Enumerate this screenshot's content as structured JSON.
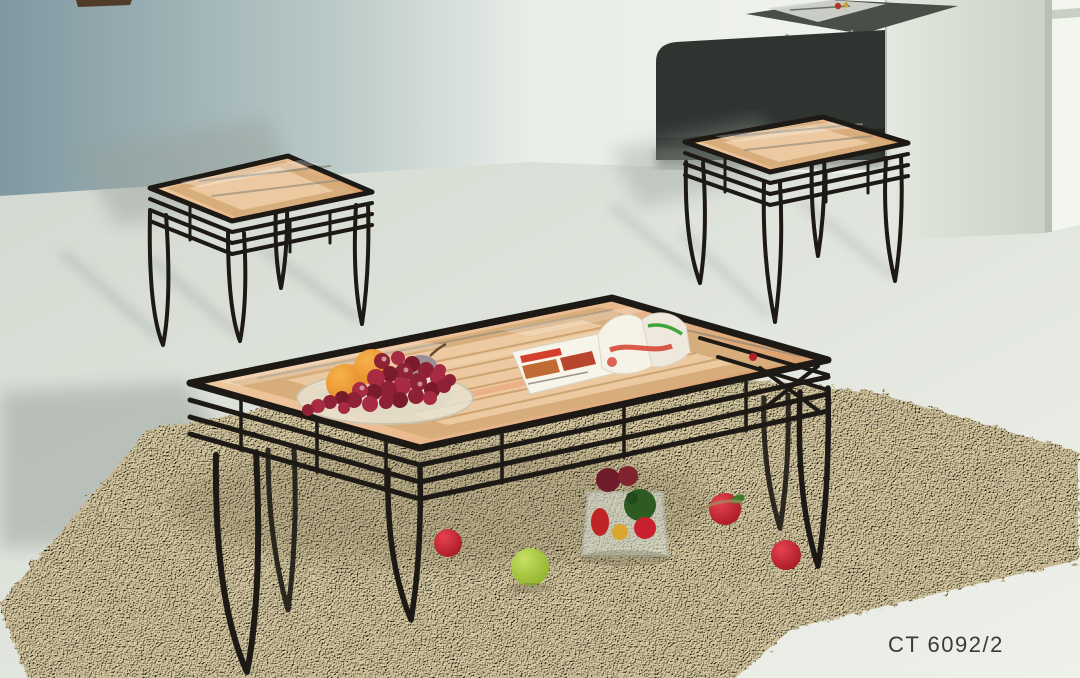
{
  "product": {
    "code": "CT 6092/2"
  },
  "scene": {
    "type": "furniture product photograph",
    "items": [
      "metal and glass coffee table",
      "left end table",
      "right end table",
      "beige shag rug",
      "glass plate with grapes and oranges",
      "open magazine",
      "glass vase with fruit and vegetables",
      "scattered red apples",
      "green apple",
      "glass desk with magazine",
      "dark chair back",
      "window strip"
    ]
  },
  "colors": {
    "wall_left": "#7f98a1",
    "wall_light": "#e9ede8",
    "window": "#f3f6ee",
    "window_frame": "#b7c0b5",
    "floor": "#dfe4db",
    "rug": "#c6b894",
    "rug_light": "#ddcfa6",
    "metal": "#1d1915",
    "lattice": "#8b8578",
    "wood": "#d8ad7c",
    "wood_light": "#ecc9a0",
    "glass_tint": "#ecd5b8",
    "chair": "#303431",
    "desk": "#494f47",
    "grapes": "#8e2133",
    "grapes_light": "#a72b42",
    "orange": "#ec9434",
    "plate": "#e9e6d6",
    "apple_red": "#c9202e",
    "apple_green": "#a4c839",
    "leaf_green": "#3e7d28",
    "mag_red": "#d5402e",
    "mag_green": "#3fa43c",
    "shadow": "#97a09a",
    "text": "#3a3a3a"
  }
}
